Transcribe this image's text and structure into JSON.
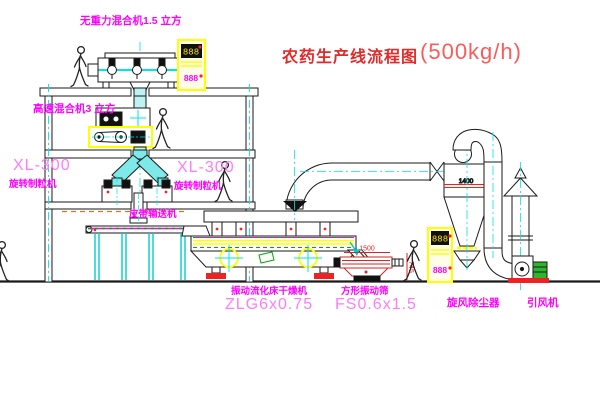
{
  "title": {
    "name_zh": "农药生产线流程图",
    "capacity": "(500kg/h)"
  },
  "equipment_labels": {
    "gravity_mixer": "无重力混合机1.5 立方",
    "high_speed_mixer": "高速混合机3 立方",
    "granulator_left_model": "XL-300",
    "granulator_left_name": "旋转制粒机",
    "granulator_right_model": "XL-300",
    "granulator_right_name": "旋转制粒机",
    "belt_conveyor": "皮带输送机",
    "fluid_bed_dryer_name": "振动流化床干燥机",
    "fluid_bed_dryer_model": "ZLG6x0.75",
    "square_screen_name": "方形振动筛",
    "square_screen_model": "FS0.6x1.5",
    "cyclone_name": "旋风除尘器",
    "fan_name": "引风机"
  },
  "dimensions": {
    "screen_length": "1500",
    "screen_height": "745",
    "cyclone_marking": "1400"
  },
  "control_panels": {
    "digital_display": "888"
  },
  "colors": {
    "label_magenta": "#ff00ff",
    "model_pink": "#ff7bff",
    "title_red": "#e02b2b",
    "dimension_red": "#ee2222",
    "duct_cyan": "#00e5e5",
    "cabinet_yellow": "#ffff00",
    "deck_yellow": "#ffff00",
    "machine_green": "#2db52d",
    "ground_black": "#1a1a1a"
  }
}
